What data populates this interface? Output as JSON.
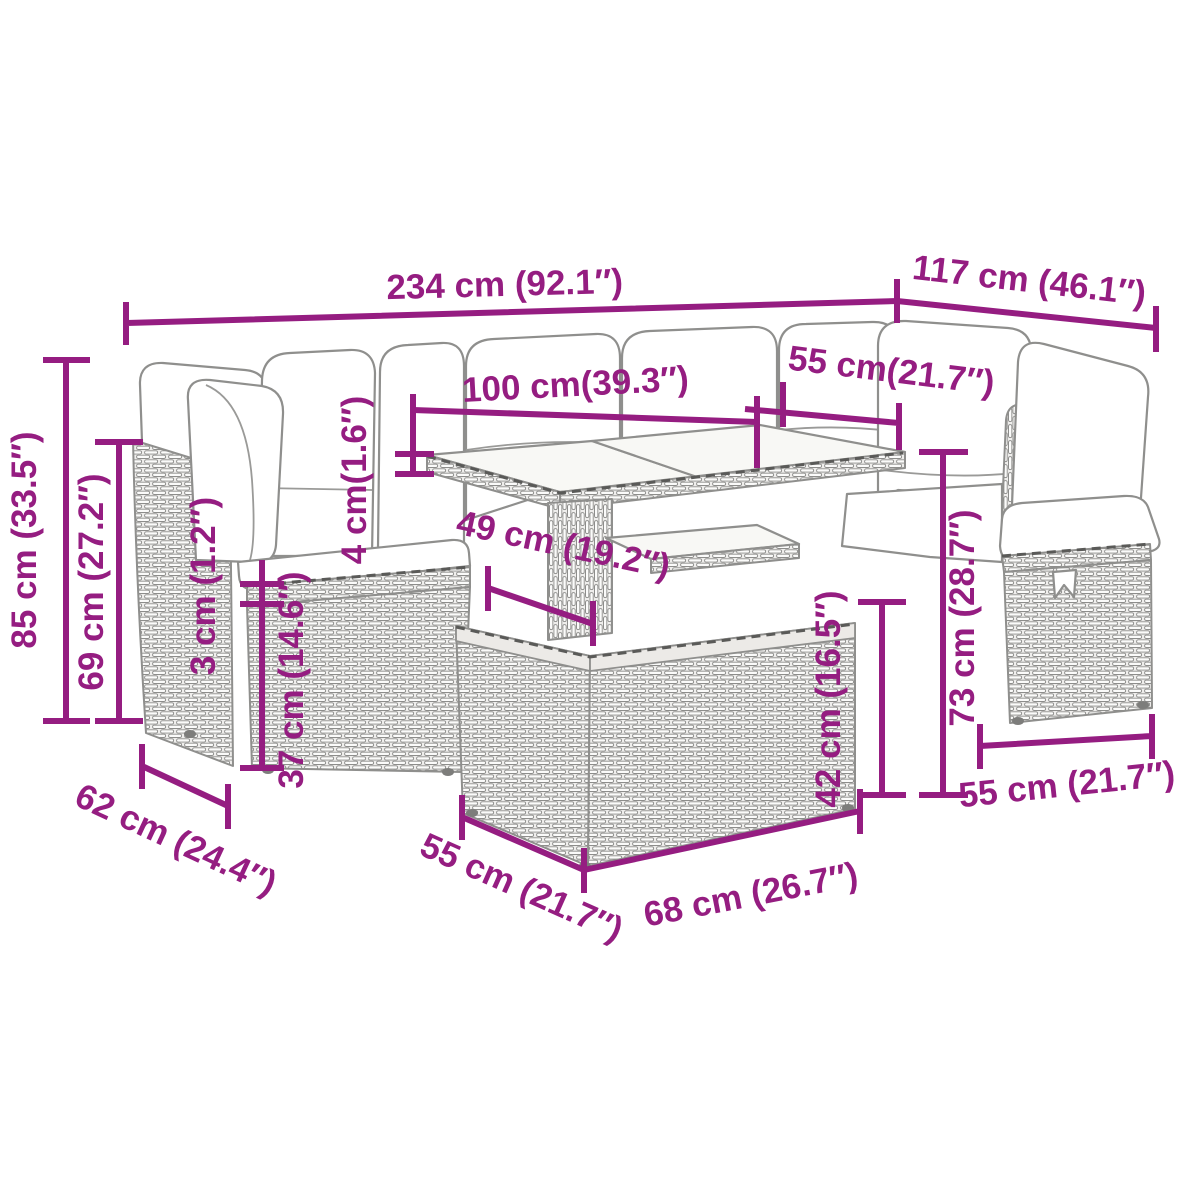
{
  "diagram": {
    "background": "#ffffff",
    "accent_color": "#951d81",
    "lineart_color": "#8f8f8d",
    "dimensions": [
      {
        "id": "total-width",
        "label": "234 cm (92.1″)",
        "value_cm": 234,
        "value_in": 92.1
      },
      {
        "id": "side-depth",
        "label": "117 cm (46.1″)",
        "value_cm": 117,
        "value_in": 46.1
      },
      {
        "id": "total-height",
        "label": "85 cm (33.5″)",
        "value_cm": 85,
        "value_in": 33.5
      },
      {
        "id": "backrest-height",
        "label": "69 cm (27.2″)",
        "value_cm": 69,
        "value_in": 27.2
      },
      {
        "id": "seat-rim-height",
        "label": "3 cm (1.2″)",
        "value_cm": 3,
        "value_in": 1.2
      },
      {
        "id": "seat-base-height",
        "label": "37 cm (14.6″)",
        "value_cm": 37,
        "value_in": 14.6
      },
      {
        "id": "tabletop-thickness",
        "label": "4 cm(1.6″)",
        "value_cm": 4,
        "value_in": 1.6
      },
      {
        "id": "tabletop-length",
        "label": "100 cm(39.3″)",
        "value_cm": 100,
        "value_in": 39.3
      },
      {
        "id": "tabletop-depth",
        "label": "55 cm(21.7″)",
        "value_cm": 55,
        "value_in": 21.7
      },
      {
        "id": "table-clearance",
        "label": "49 cm (19.2″)",
        "value_cm": 49,
        "value_in": 19.2
      },
      {
        "id": "table-base-height",
        "label": "42 cm (16.5″)",
        "value_cm": 42,
        "value_in": 16.5
      },
      {
        "id": "table-height",
        "label": "73 cm (28.7″)",
        "value_cm": 73,
        "value_in": 28.7
      },
      {
        "id": "ottoman-width",
        "label": "55 cm (21.7″)",
        "value_cm": 55,
        "value_in": 21.7
      },
      {
        "id": "seat-depth",
        "label": "62 cm (24.4″)",
        "value_cm": 62,
        "value_in": 24.4
      },
      {
        "id": "table-base-depth",
        "label": "55 cm (21.7″)",
        "value_cm": 55,
        "value_in": 21.7
      },
      {
        "id": "table-base-width",
        "label": "68 cm (26.7″)",
        "value_cm": 68,
        "value_in": 26.7
      }
    ]
  }
}
